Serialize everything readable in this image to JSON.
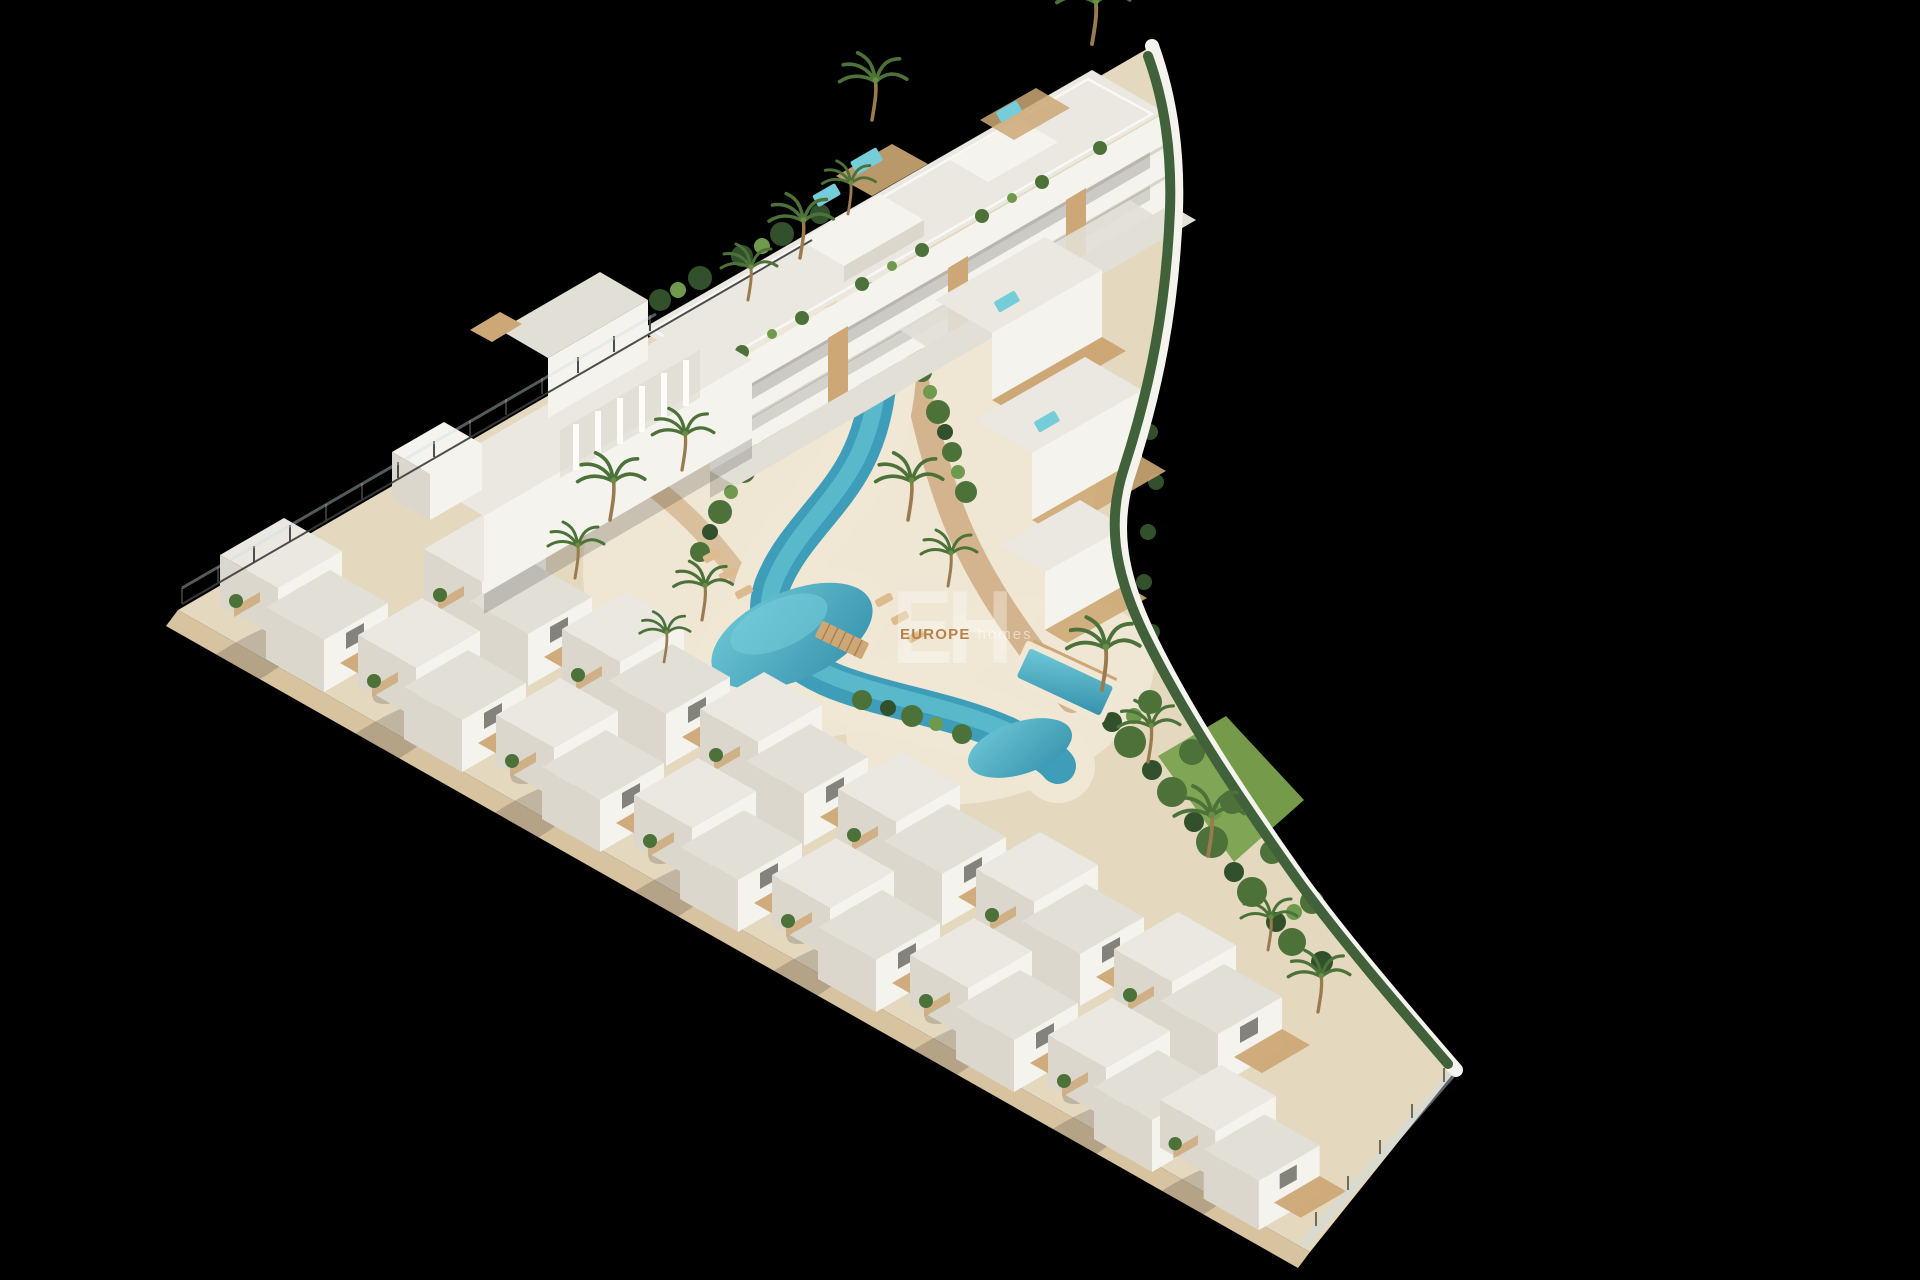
{
  "meta": {
    "title": "Aerial 3D architectural render of a new-build coastal residential complex on black background"
  },
  "scene": {
    "site_shape": "triangular plot, left vertex at left edge, curved wall on right side",
    "features": [
      "three-storey apartment block with roof terraces and plunge pools along top edge",
      "fin-and-arch white building mid-left",
      "two staggered rows of white townhouses with wooden decks along lower-left edge",
      "winding lagoon-style communal pool with sandy beach in the centre",
      "stepped villas with rooftop jacuzzis and a private pool on the right",
      "palm garden, lawn and hedge along the curved boundary wall",
      "glass-and-post perimeter fences at left vertex and bottom-right edge",
      "wooden footbridge over the pool channel",
      "sun loungers on the beach"
    ]
  },
  "watermark": {
    "logo": "EH",
    "brand": "EUROPE",
    "brand_suffix": "homes"
  },
  "palette": {
    "background": "#000000",
    "sand": "#e4d8bf",
    "platform": "#d7c3a0",
    "beach": "#f0e8d5",
    "path": "#c79e70",
    "wood": "#cda876",
    "building_white": "#f5f3ed",
    "building_shade": "#dbd7cd",
    "roof": "#eae8e1",
    "roof2": "#e2dfd7",
    "pool_deep": "#3e9db9",
    "pool_mid": "#5cbccd",
    "pool_light": "#74cdd9",
    "green_dark": "#31502b",
    "green": "#4c7239",
    "green_light": "#6f9a4d",
    "hedge": "#40613a",
    "lawn": "#7aa24e",
    "fence": "#3d3d3d",
    "glass": "#cfe0e6"
  }
}
